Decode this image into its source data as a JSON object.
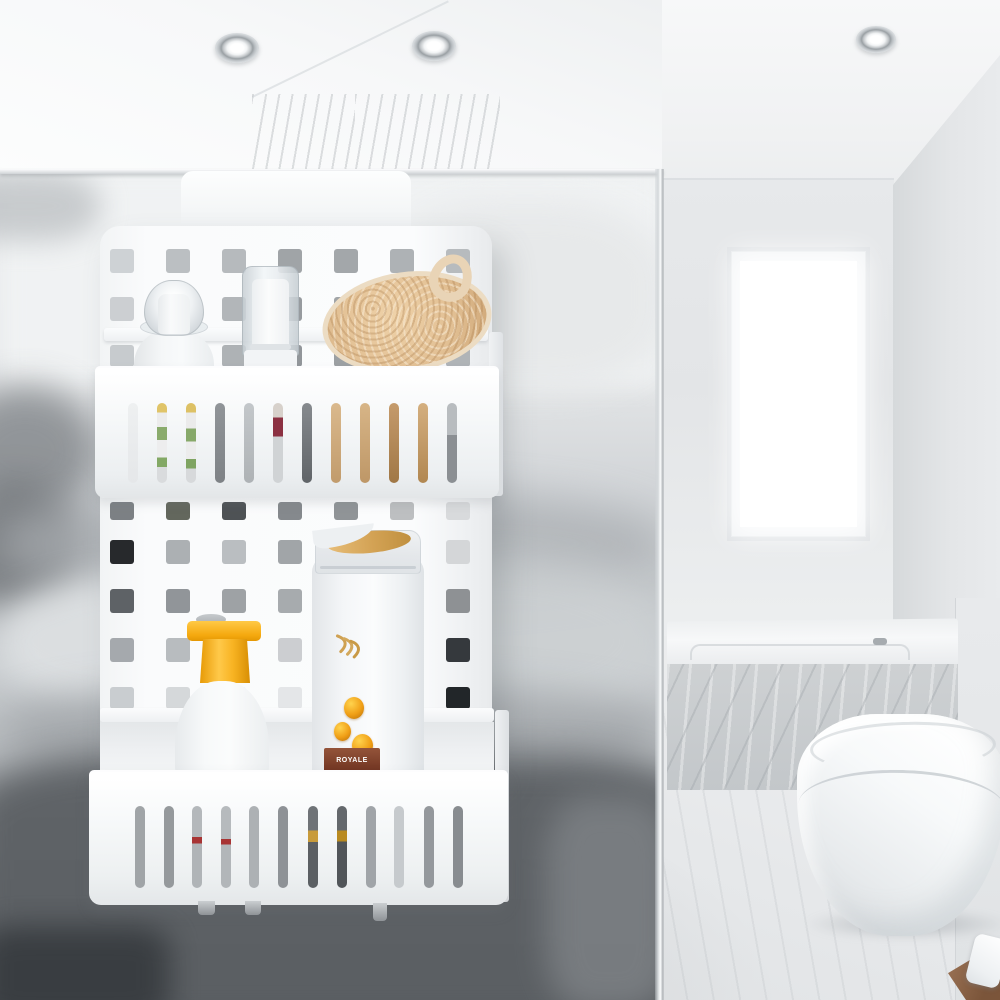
{
  "meta": {
    "description": "Product photo: white over-screen hanging shower caddy (two perforated baskets) filled with toiletries, hung on a glass shower screen in a bright marble attic bathroom",
    "width": 1000,
    "height": 1000
  },
  "palette": {
    "caddy_white": "#f8fafb",
    "glass_tint": "#c7cbce",
    "wall_grey": "#e6e8ea",
    "marble_grey": "#cbcfd2",
    "floor_grey": "#e7e9ea",
    "dark_blur": "#4e5256",
    "yellow_cap": "#f6ac18",
    "gold_accent": "#d3a254",
    "amber_drop": "#e89b1c",
    "label_red": "#7c4028",
    "loofah_tan": "#e2c29a",
    "wood_brown": "#8a6547"
  },
  "room": {
    "objects": [
      "sloped white ceiling",
      "recessed spotlights",
      "marble shower column",
      "frosted window",
      "glass shower screen",
      "marble-clad bathtub",
      "wall-hung toilet",
      "marble floor",
      "wooden tray with soap"
    ],
    "lights": [
      {
        "x": 215,
        "y": 33,
        "w": 44,
        "h": 30
      },
      {
        "x": 412,
        "y": 31,
        "w": 44,
        "h": 30
      },
      {
        "x": 856,
        "y": 26,
        "w": 40,
        "h": 27
      }
    ]
  },
  "glass": {
    "blobs": [
      {
        "x": 0,
        "y": 0,
        "w": 663,
        "h": 215,
        "bg": "#f0f2f3",
        "blur": 12,
        "op": 1,
        "br": "0"
      },
      {
        "x": 380,
        "y": 30,
        "w": 290,
        "h": 190,
        "bg": "#e6e8e9",
        "blur": 16,
        "op": 0.85,
        "br": "40%"
      },
      {
        "x": -50,
        "y": 0,
        "w": 150,
        "h": 70,
        "bg": "#b7bbbe",
        "blur": 14,
        "op": 0.7,
        "br": "40%"
      },
      {
        "x": -50,
        "y": 215,
        "w": 150,
        "h": 130,
        "bg": "#85898d",
        "blur": 18,
        "op": 0.85,
        "br": "50%"
      },
      {
        "x": -55,
        "y": 310,
        "w": 140,
        "h": 130,
        "bg": "#6f7377",
        "blur": 18,
        "op": 0.85,
        "br": "50%"
      },
      {
        "x": 0,
        "y": 320,
        "w": 663,
        "h": 105,
        "bg": "#aaaeb2",
        "blur": 20,
        "op": 0.7,
        "br": "40%"
      },
      {
        "x": 0,
        "y": 405,
        "w": 350,
        "h": 130,
        "bg": "#dee1e3",
        "blur": 16,
        "op": 0.9,
        "br": "40%"
      },
      {
        "x": 340,
        "y": 385,
        "w": 330,
        "h": 170,
        "bg": "#ced2d4",
        "blur": 20,
        "op": 0.75,
        "br": "50%"
      },
      {
        "x": 0,
        "y": 515,
        "w": 663,
        "h": 95,
        "bg": "#9fa3a7",
        "blur": 20,
        "op": 0.75,
        "br": "40%"
      },
      {
        "x": -30,
        "y": 585,
        "w": 730,
        "h": 270,
        "bg": "#5c6064",
        "blur": 18,
        "op": 0.95,
        "br": "20%"
      },
      {
        "x": -20,
        "y": 755,
        "w": 190,
        "h": 100,
        "bg": "#383c40",
        "blur": 14,
        "op": 0.95,
        "br": "20%"
      },
      {
        "x": 545,
        "y": 625,
        "w": 130,
        "h": 215,
        "bg": "#7d8185",
        "blur": 16,
        "op": 0.85,
        "br": "30%"
      }
    ]
  },
  "caddy": {
    "color": "#f8fafb",
    "hole_w": 24,
    "cols_x": [
      110,
      166,
      222,
      278,
      334,
      390,
      446
    ],
    "hole_rows": [
      {
        "y": 249,
        "h": 24,
        "colors": [
          "#ced2d5",
          "#bbbfc2",
          "#b6babd",
          "#a0a4a7",
          "#a3a7aa",
          "#aeb2b5",
          "#b7bbbe"
        ]
      },
      {
        "y": 297,
        "h": 24,
        "colors": [
          "#cccfd2",
          "#b7bbbe",
          "#b2b6b9",
          "#979b9f",
          "#a0a4a7",
          "#abafb2",
          "#b4b8bb"
        ]
      },
      {
        "y": 345,
        "h": 22,
        "colors": [
          "#c7cbce",
          "#b2b6b9",
          "#aeb2b5",
          "#92969a",
          "#9ca0a3",
          "#a7abae",
          "#b0b4b7"
        ]
      },
      {
        "y": 502,
        "h": 18,
        "colors": [
          "#7c8084",
          "#63675d",
          "#4e5255",
          "#85898d",
          "#909497",
          "#bdbfc1",
          "#d8dadc"
        ]
      },
      {
        "y": 540,
        "h": 24,
        "colors": [
          "#27292c",
          "#acb0b3",
          "#babec1",
          "#a1a5a8",
          "#bfc2c5",
          "#c7cacd",
          "#d4d6d8"
        ]
      },
      {
        "y": 589,
        "h": 24,
        "colors": [
          "#5e6266",
          "#919599",
          "#9ea2a5",
          "#a7abae",
          "#b8bbbe",
          "#c4c7ca",
          "#8e9194"
        ]
      },
      {
        "y": 638,
        "h": 24,
        "colors": [
          "#a5a9ad",
          "#b8bcbf",
          "#c4c7ca",
          "#ccced1",
          "#d3d5d7",
          "#d9dbdd",
          "#35393d"
        ]
      },
      {
        "y": 687,
        "h": 22,
        "colors": [
          "#c9cdd0",
          "#d5d8da",
          "#dee1e3",
          "#e4e6e8",
          "#e8eaeb",
          "#eceded",
          "#222629"
        ]
      }
    ],
    "slots_upper": {
      "y": 403,
      "h": 80,
      "w": 10,
      "x": [
        128,
        157,
        186,
        215,
        244,
        273,
        302,
        331,
        360,
        389,
        418,
        447
      ],
      "colors": [
        "linear-gradient(180deg,#eef0f1,#e5e7e9)",
        "linear-gradient(180deg,#e0c468 0 12%,#ececec 12% 30%,#8aab6c 30% 46%,#ededee 46% 68%,#83a865 68% 80%,#d9dbdd 80%)",
        "linear-gradient(180deg,#ddc165 0 12%,#ebebeb 12% 32%,#87a96a 32% 48%,#ececec 48% 70%,#7fa462 70% 82%,#d7d9db 82%)",
        "linear-gradient(180deg,#909498,#7e8286)",
        "linear-gradient(180deg,#c3c7ca,#aeb2b5)",
        "linear-gradient(180deg,#d7d1cb 0 18%,#8c3142 18% 42%,#d0d3d5 42%)",
        "linear-gradient(180deg,#868a8e,#606468)",
        "linear-gradient(180deg,#dab98d,#c19b6c)",
        "linear-gradient(180deg,#d7b587,#be9767)",
        "linear-gradient(180deg,#c59b6c,#a07746)",
        "linear-gradient(180deg,#d4af7f,#b18751)",
        "linear-gradient(180deg,#b8bcbf 0 40%,#8b8f93 40%)"
      ]
    },
    "slots_lower": {
      "y": 806,
      "h": 82,
      "w": 10,
      "x": [
        135,
        164,
        192,
        221,
        249,
        278,
        308,
        337,
        366,
        394,
        424,
        453
      ],
      "colors": [
        "#a0a4a7",
        "#95999c",
        "linear-gradient(180deg,#b4b8bb 0 38%,#a83434 38% 46%,#b0b4b7 46%)",
        "linear-gradient(180deg,#b6babd 0 40%,#a83434 40% 47%,#b2b6b9 47%)",
        "#adb1b4",
        "#8e9296",
        "linear-gradient(180deg,#6f7377 0 30%,#c89b3b 30% 44%,#5b5f63 44%)",
        "linear-gradient(180deg,#64686c 0 30%,#b98a20 30% 43%,#515559 43%)",
        "#a0a4a8",
        "#c6cacd",
        "#94989c",
        "#888c90"
      ]
    },
    "nubs": [
      {
        "x": 198,
        "y": 901,
        "w": 17,
        "h": 14
      },
      {
        "x": 245,
        "y": 901,
        "w": 16,
        "h": 14
      },
      {
        "x": 373,
        "y": 903,
        "w": 14,
        "h": 18
      }
    ]
  },
  "products": {
    "clear_bottle": {
      "name": "clear dome pump bottle"
    },
    "pump_bottle": {
      "name": "frosted pump dispenser"
    },
    "loofah": {
      "name": "loofah bath sponge"
    },
    "yellow_bottle": {
      "name": "frosted bottle with yellow cap"
    },
    "shampoo": {
      "name": "shampoo bottle",
      "label_text": "ROYALE"
    }
  }
}
